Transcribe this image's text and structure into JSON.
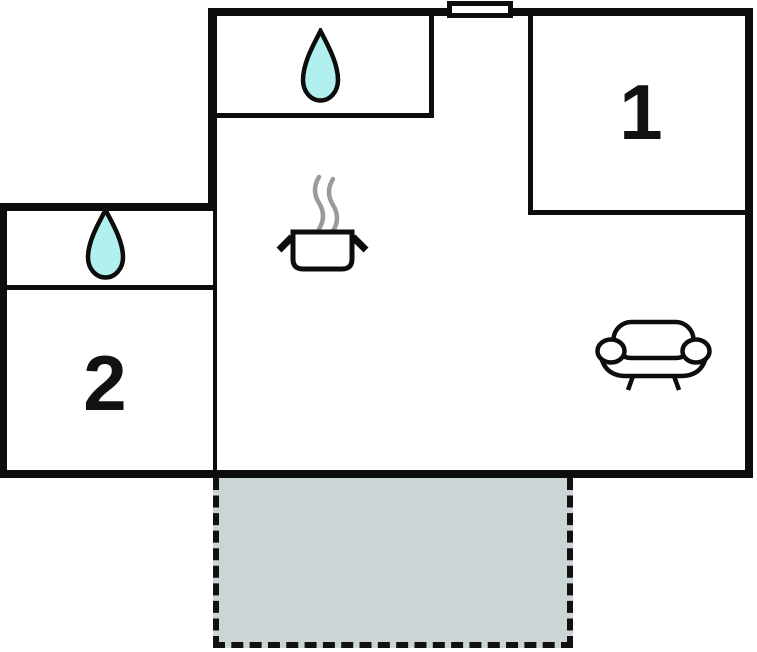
{
  "plan": {
    "kind": "floor-plan",
    "rooms": [
      {
        "label": "1"
      },
      {
        "label": "2"
      }
    ],
    "icons": [
      {
        "name": "water-drop-icon",
        "area": "top-strip-room"
      },
      {
        "name": "water-drop-icon",
        "area": "left-annex-room"
      },
      {
        "name": "cooking-pot-icon",
        "area": "main-room"
      },
      {
        "name": "sofa-icon",
        "area": "main-room"
      },
      {
        "name": "door-window",
        "area": "top-wall"
      }
    ],
    "areas": [
      {
        "name": "terrace",
        "style": "dashed-outline"
      }
    ],
    "colors": {
      "wall": "#0d0d0d",
      "background": "#ffffff",
      "water_drop_fill": "#b2f0f0",
      "terrace_fill": "#cbd5d6",
      "steam": "#9a9a9a",
      "dash": "#111111"
    }
  }
}
